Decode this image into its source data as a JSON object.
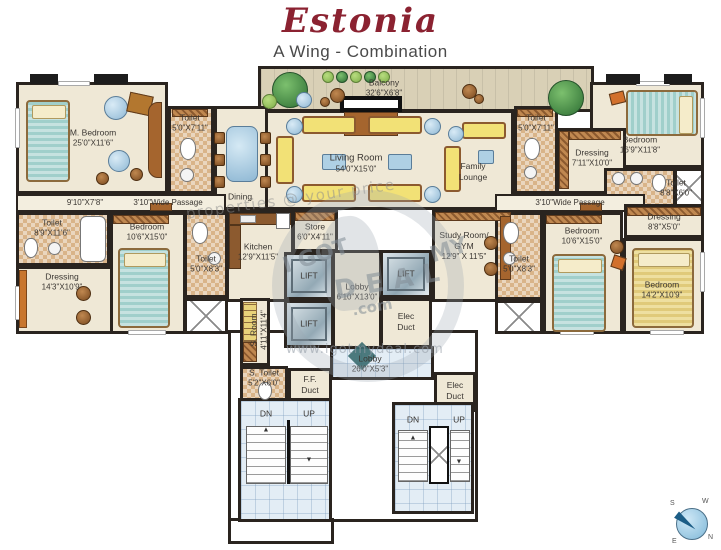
{
  "header": {
    "title": "Estonia",
    "subtitle": "A Wing - Combination"
  },
  "rooms": {
    "m_bedroom": {
      "name": "M. Bedroom",
      "dims": "25'0\"X11'6\""
    },
    "sitting": {
      "dims": "9'10\"X7'8\""
    },
    "passage": {
      "name": "3'10\"Wide Passage"
    },
    "toilet_upper_left": {
      "name": "Toilet",
      "dims": "5'0\"X7'11\""
    },
    "dining": {
      "name": "Dining"
    },
    "balcony": {
      "name": "Balcony",
      "dims": "32'6\"X6'8\""
    },
    "living": {
      "name": "Living Room",
      "dims": "54'0\"X15'0\""
    },
    "family_lounge": {
      "name": "Family",
      "name2": "Lounge"
    },
    "toilet_left": {
      "name": "Toilet",
      "dims": "8'9\"X11'6\""
    },
    "dressing_left": {
      "name": "Dressing",
      "dims": "14'3\"X10'9\""
    },
    "bedroom_left": {
      "name": "Bedroom",
      "dims": "10'6\"X15'0\""
    },
    "toilet_mid_left": {
      "name": "Toilet",
      "dims": "5'0\"X8'3\""
    },
    "kitchen": {
      "name": "Kitchen",
      "dims": "12'9\"X11'5\""
    },
    "store": {
      "name": "Store",
      "dims": "6'0\"X4'11\""
    },
    "lift": {
      "name": "LIFT"
    },
    "lobby_core": {
      "name": "Lobby",
      "dims": "6'10\"X13'0\""
    },
    "elec_duct": {
      "name": "Elec",
      "name2": "Duct"
    },
    "s_room": {
      "name": "S. Room",
      "dims": "4'11\"X11'4\""
    },
    "s_toilet": {
      "name": "S. Toilet",
      "dims": "5'2\"X6'0\""
    },
    "ff_duct": {
      "name": "F.F.",
      "name2": "Duct"
    },
    "lobby_bottom": {
      "name": "Lobby",
      "dims": "26'0\"X5'3\""
    },
    "study": {
      "name": "Study Room/",
      "name2": "GYM",
      "dims": "12'9\" X 11'5\""
    },
    "toilet_upper_right": {
      "name": "Toilet",
      "dims": "5'0\"X7'11\""
    },
    "dressing_upper_right": {
      "name": "Dressing",
      "dims": "7'11\"X10'0\""
    },
    "bedroom_top_right": {
      "name": "Bedroom",
      "dims": "16'9\"X11'8\""
    },
    "toilet_right_edge": {
      "name": "Toilet",
      "dims": "8'8\"X6'0\""
    },
    "dressing_right": {
      "name": "Dressing",
      "dims": "8'8\"X5'0\""
    },
    "toilet_mid_right": {
      "name": "Toilet",
      "dims": "5'0\"X8'3\""
    },
    "bedroom_mid_right": {
      "name": "Bedroom",
      "dims": "10'6\"X15'0\""
    },
    "bedroom_bottom_right": {
      "name": "Bedroom",
      "dims": "14'2\"X10'9\""
    }
  },
  "stairs": {
    "dn": "DN",
    "up": "UP",
    "arrow_up": "▲",
    "arrow_down": "▼"
  },
  "watermark": {
    "i_got": "I GOT",
    "my": "MY",
    "deal": "DEAL",
    "dotcom": ".com",
    "url": "www.igotmydeal.com",
    "diagonal": "properties @ your price"
  },
  "compass": {
    "n": "N",
    "s": "S",
    "e": "E",
    "w": "W"
  }
}
